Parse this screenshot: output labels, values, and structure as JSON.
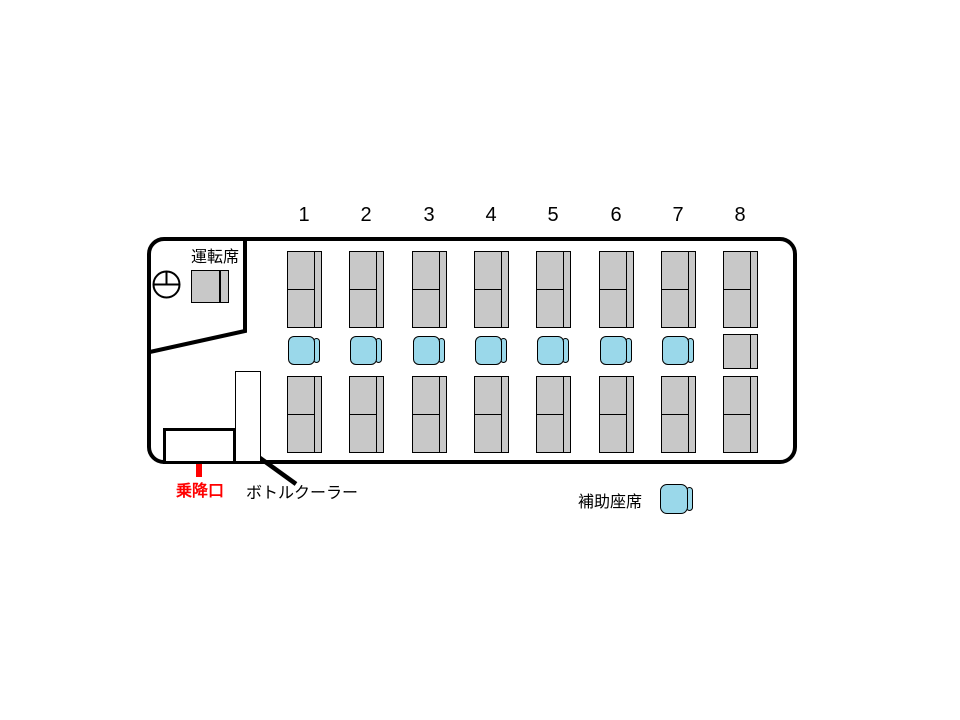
{
  "colors": {
    "seat_gray": "#C8C8C8",
    "seat_blue": "#9AD8EA",
    "accent_red": "#FF0000",
    "line_black": "#000000"
  },
  "driver": {
    "label": "運転席"
  },
  "entrance": {
    "label": "乗降口"
  },
  "bottle_cooler": {
    "label": "ボトルクーラー"
  },
  "legend": {
    "label": "補助座席"
  },
  "seat_columns": [
    {
      "label": "1",
      "front": "double",
      "middle": "aux",
      "rear": "double"
    },
    {
      "label": "2",
      "front": "double",
      "middle": "aux",
      "rear": "double"
    },
    {
      "label": "3",
      "front": "double",
      "middle": "aux",
      "rear": "double"
    },
    {
      "label": "4",
      "front": "double",
      "middle": "aux",
      "rear": "double"
    },
    {
      "label": "5",
      "front": "double",
      "middle": "aux",
      "rear": "double"
    },
    {
      "label": "6",
      "front": "double",
      "middle": "aux",
      "rear": "double"
    },
    {
      "label": "7",
      "front": "double",
      "middle": "aux",
      "rear": "double"
    },
    {
      "label": "8",
      "front": "double",
      "middle": "single",
      "rear": "double"
    }
  ]
}
